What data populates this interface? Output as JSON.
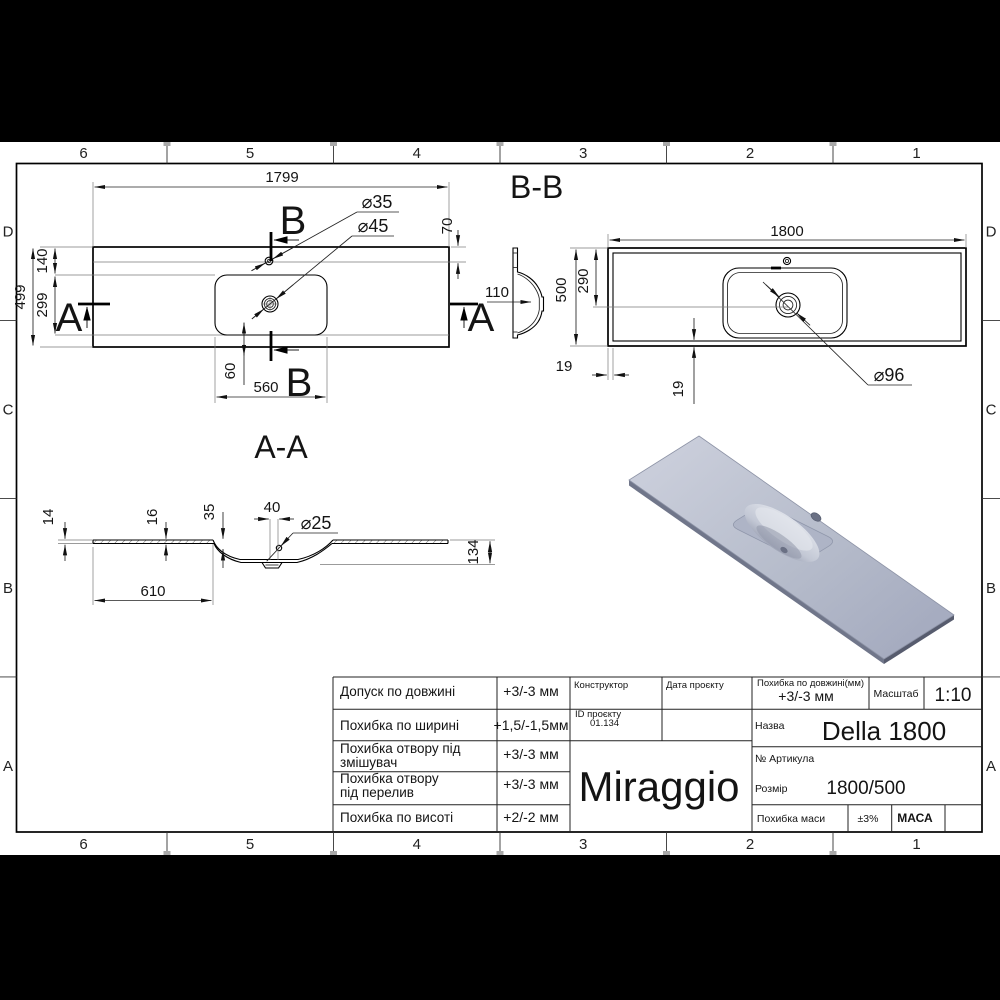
{
  "sheet": {
    "border_cols": [
      "6",
      "5",
      "4",
      "3",
      "2",
      "1"
    ],
    "border_rows": [
      "D",
      "C",
      "B",
      "A"
    ]
  },
  "top_view": {
    "length": "1799",
    "d35": "⌀35",
    "d45": "⌀45",
    "h70": "70",
    "v140": "140",
    "v299": "299",
    "v499": "499",
    "v60": "60",
    "w560": "560",
    "side110": "110",
    "sec_b": "B",
    "sec_a": "A"
  },
  "section_bb": {
    "title": "B-B",
    "length": "1800",
    "h500": "500",
    "h290": "290",
    "t19": "19",
    "d96": "⌀96"
  },
  "section_aa": {
    "title": "A-A",
    "t14": "14",
    "t16": "16",
    "t35": "35",
    "w40": "40",
    "d25": "⌀25",
    "h134": "134",
    "w610": "610"
  },
  "title_block": {
    "rows": [
      {
        "lines": [
          "Допуск по довжині"
        ],
        "value": "+3/-3 мм"
      },
      {
        "lines": [
          "Похибка по ширині"
        ],
        "value": "+1,5/-1,5мм"
      },
      {
        "lines": [
          "Похибка отвору під",
          "змішувач"
        ],
        "value": "+3/-3 мм"
      },
      {
        "lines": [
          "Похибка отвору",
          "під перелив"
        ],
        "value": "+3/-3 мм"
      },
      {
        "lines": [
          "Похибка по висоті"
        ],
        "value": "+2/-2 мм"
      }
    ],
    "constructor_label": "Конструктор",
    "date_label": "Дата проєкту",
    "id_label": "ID проєкту",
    "id_value": "01.134",
    "logo": "Miraggio",
    "len_tol_label": "Похибка по довжині(мм)",
    "len_tol_value": "+3/-3 мм",
    "scale_label": "Масштаб",
    "scale_value": "1:10",
    "name_label": "Назва",
    "name_value": "Della 1800",
    "article_label": "№ Артикула",
    "size_label": "Розмір",
    "size_value": "1800/500",
    "mass_tol_label": "Похибка маси",
    "mass_tol_value": "±3%",
    "mass_label": "МАСА"
  }
}
